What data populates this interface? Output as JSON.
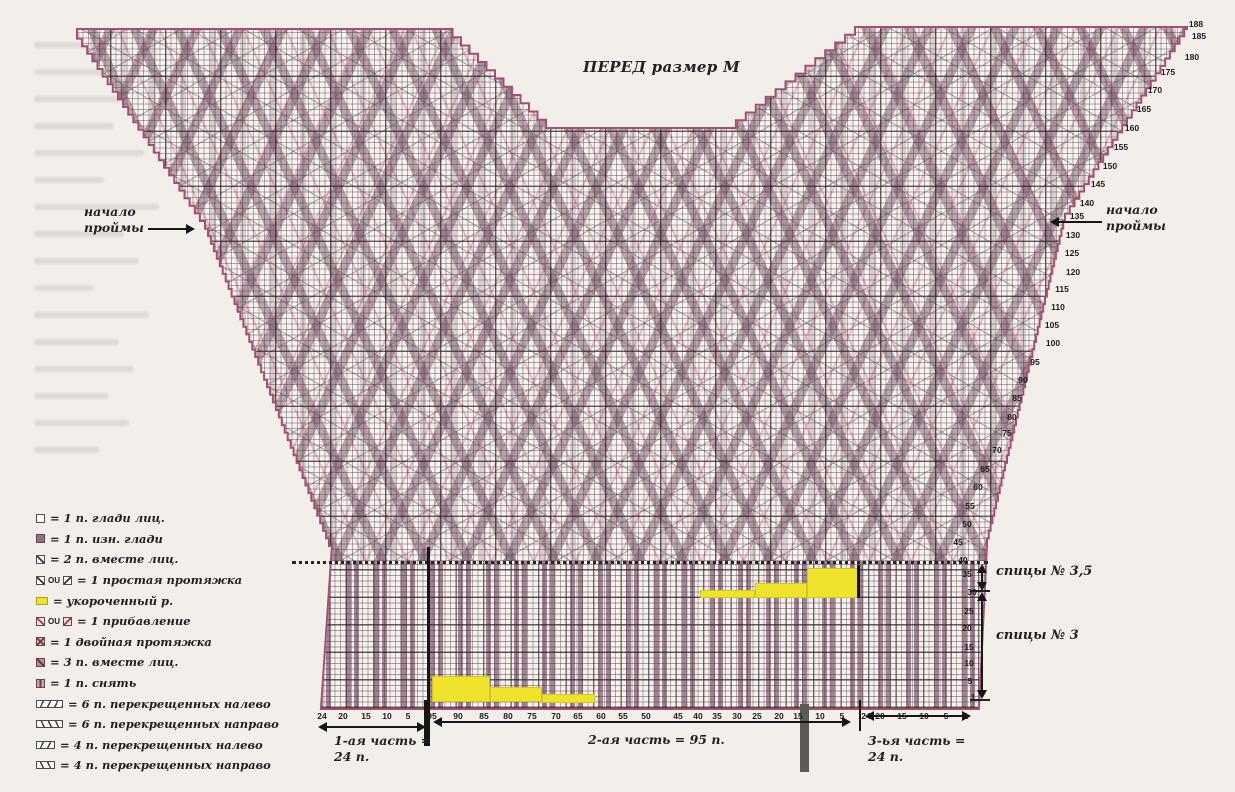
{
  "title": "ПЕРЕД размер М",
  "colors": {
    "border": "#a3506e",
    "stripe": "#8c6e7e",
    "highlight_yellow": "#efe32b",
    "dotted_pink": "#d9799c",
    "grid": "#3b3337",
    "text": "#262224"
  },
  "legend": {
    "items": [
      {
        "icons": [
          "sq-empty"
        ],
        "label": "= 1 п. глади лиц."
      },
      {
        "icons": [
          "sq-fill"
        ],
        "label": "= 1 п. изн. глади"
      },
      {
        "icons": [
          "sq-slash"
        ],
        "label": "= 2 п. вместе лиц."
      },
      {
        "icons": [
          "sq-slash",
          "text:OU",
          "sq-backslash"
        ],
        "label": "= 1 простая протяжка"
      },
      {
        "icons": [
          "sq-yellow"
        ],
        "label": "= укороченный р."
      },
      {
        "icons": [
          "sq-slash-red",
          "text:OU",
          "sq-backslash-red"
        ],
        "label": "= 1 прибавление"
      },
      {
        "icons": [
          "sq-double"
        ],
        "label": "= 1 двойная протяжка"
      },
      {
        "icons": [
          "sq-three"
        ],
        "label": "= 3 п. вместе лиц."
      },
      {
        "icons": [
          "sq-slip"
        ],
        "label": "= 1 п. снять"
      },
      {
        "icons": [
          "cable6-left"
        ],
        "label": "= 6 п. перекрещенных налево"
      },
      {
        "icons": [
          "cable6-right"
        ],
        "label": "= 6 п. перекрещенных направо"
      },
      {
        "icons": [
          "cable4-left"
        ],
        "label": "= 4 п. перекрещенных налево"
      },
      {
        "icons": [
          "cable4-right"
        ],
        "label": "= 4 п. перекрещенных направо"
      }
    ]
  },
  "annotations": {
    "armhole_left": {
      "line1": "начало",
      "line2": "проймы"
    },
    "armhole_right": {
      "line1": "начало",
      "line2": "проймы"
    },
    "needles_35": "спицы № 3,5",
    "needles_3": "спицы № 3",
    "part1_line1": "1-ая часть =",
    "part1_line2": "24 п.",
    "part2": "2-ая часть = 95 п.",
    "part3_line1": "3-ья часть =",
    "part3_line2": "24 п."
  },
  "row_numbers": [
    {
      "v": "188",
      "x": 1196,
      "y": 24
    },
    {
      "v": "185",
      "x": 1199,
      "y": 36
    },
    {
      "v": "180",
      "x": 1192,
      "y": 57
    },
    {
      "v": "175",
      "x": 1168,
      "y": 72
    },
    {
      "v": "170",
      "x": 1155,
      "y": 90
    },
    {
      "v": "165",
      "x": 1144,
      "y": 109
    },
    {
      "v": "160",
      "x": 1132,
      "y": 128
    },
    {
      "v": "155",
      "x": 1121,
      "y": 147
    },
    {
      "v": "150",
      "x": 1110,
      "y": 166
    },
    {
      "v": "145",
      "x": 1098,
      "y": 184
    },
    {
      "v": "140",
      "x": 1087,
      "y": 203
    },
    {
      "v": "135",
      "x": 1077,
      "y": 216
    },
    {
      "v": "130",
      "x": 1073,
      "y": 235
    },
    {
      "v": "125",
      "x": 1072,
      "y": 253
    },
    {
      "v": "120",
      "x": 1073,
      "y": 272
    },
    {
      "v": "115",
      "x": 1062,
      "y": 289
    },
    {
      "v": "110",
      "x": 1058,
      "y": 307
    },
    {
      "v": "105",
      "x": 1052,
      "y": 325
    },
    {
      "v": "100",
      "x": 1053,
      "y": 343
    },
    {
      "v": "95",
      "x": 1035,
      "y": 362
    },
    {
      "v": "90",
      "x": 1023,
      "y": 380
    },
    {
      "v": "85",
      "x": 1017,
      "y": 398
    },
    {
      "v": "80",
      "x": 1012,
      "y": 417
    },
    {
      "v": "75",
      "x": 1007,
      "y": 433
    },
    {
      "v": "70",
      "x": 997,
      "y": 450
    },
    {
      "v": "65",
      "x": 985,
      "y": 469
    },
    {
      "v": "60",
      "x": 978,
      "y": 487
    },
    {
      "v": "55",
      "x": 970,
      "y": 506
    },
    {
      "v": "50",
      "x": 967,
      "y": 524
    },
    {
      "v": "45",
      "x": 958,
      "y": 542
    },
    {
      "v": "40",
      "x": 963,
      "y": 560
    },
    {
      "v": "35",
      "x": 967,
      "y": 574
    },
    {
      "v": "30",
      "x": 972,
      "y": 592
    },
    {
      "v": "25",
      "x": 969,
      "y": 611
    },
    {
      "v": "20",
      "x": 967,
      "y": 628
    },
    {
      "v": "15",
      "x": 969,
      "y": 647
    },
    {
      "v": "10",
      "x": 969,
      "y": 663
    },
    {
      "v": "5",
      "x": 970,
      "y": 681
    },
    {
      "v": "1",
      "x": 973,
      "y": 697
    }
  ],
  "stitch_numbers": [
    {
      "v": "24",
      "x": 322
    },
    {
      "v": "20",
      "x": 343
    },
    {
      "v": "15",
      "x": 366
    },
    {
      "v": "10",
      "x": 387
    },
    {
      "v": "5",
      "x": 408
    },
    {
      "v": "95",
      "x": 432
    },
    {
      "v": "90",
      "x": 458
    },
    {
      "v": "85",
      "x": 484
    },
    {
      "v": "80",
      "x": 508
    },
    {
      "v": "75",
      "x": 532
    },
    {
      "v": "70",
      "x": 556
    },
    {
      "v": "65",
      "x": 578
    },
    {
      "v": "60",
      "x": 601
    },
    {
      "v": "55",
      "x": 623
    },
    {
      "v": "50",
      "x": 646
    },
    {
      "v": "45",
      "x": 678
    },
    {
      "v": "40",
      "x": 698
    },
    {
      "v": "35",
      "x": 717
    },
    {
      "v": "30",
      "x": 737
    },
    {
      "v": "25",
      "x": 757
    },
    {
      "v": "20",
      "x": 779
    },
    {
      "v": "15",
      "x": 798
    },
    {
      "v": "10",
      "x": 820
    },
    {
      "v": "5",
      "x": 842
    },
    {
      "v": "24",
      "x": 866
    },
    {
      "v": "20",
      "x": 880
    },
    {
      "v": "15",
      "x": 902
    },
    {
      "v": "10",
      "x": 924
    },
    {
      "v": "5",
      "x": 946
    },
    {
      "v": "1",
      "x": 966
    }
  ]
}
